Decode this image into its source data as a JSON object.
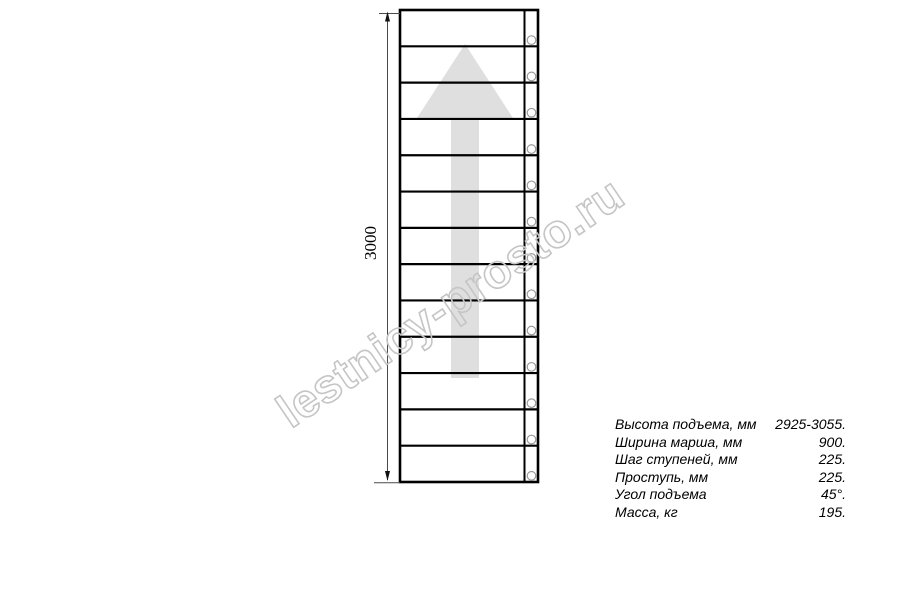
{
  "drawing": {
    "dimension_label": "3000",
    "watermark": "lestnicy-prosto.ru",
    "steps_count": 13,
    "colors": {
      "line": "#000000",
      "dim_line": "#4a4a4a",
      "arrow_fill": "#dfdfdf",
      "circle_stroke": "#9b9b9b",
      "watermark_stroke": "#c5c5c5"
    }
  },
  "specs": {
    "rows": [
      {
        "label": "Высота подъема, мм",
        "value": "2925-3055."
      },
      {
        "label": "Ширина марша, мм",
        "value": "900."
      },
      {
        "label": "Шаг ступеней, мм",
        "value": "225."
      },
      {
        "label": "Проступь, мм",
        "value": "225."
      },
      {
        "label": "Угол подъема",
        "value": "45°."
      },
      {
        "label": "Масса, кг",
        "value": "195."
      }
    ]
  }
}
